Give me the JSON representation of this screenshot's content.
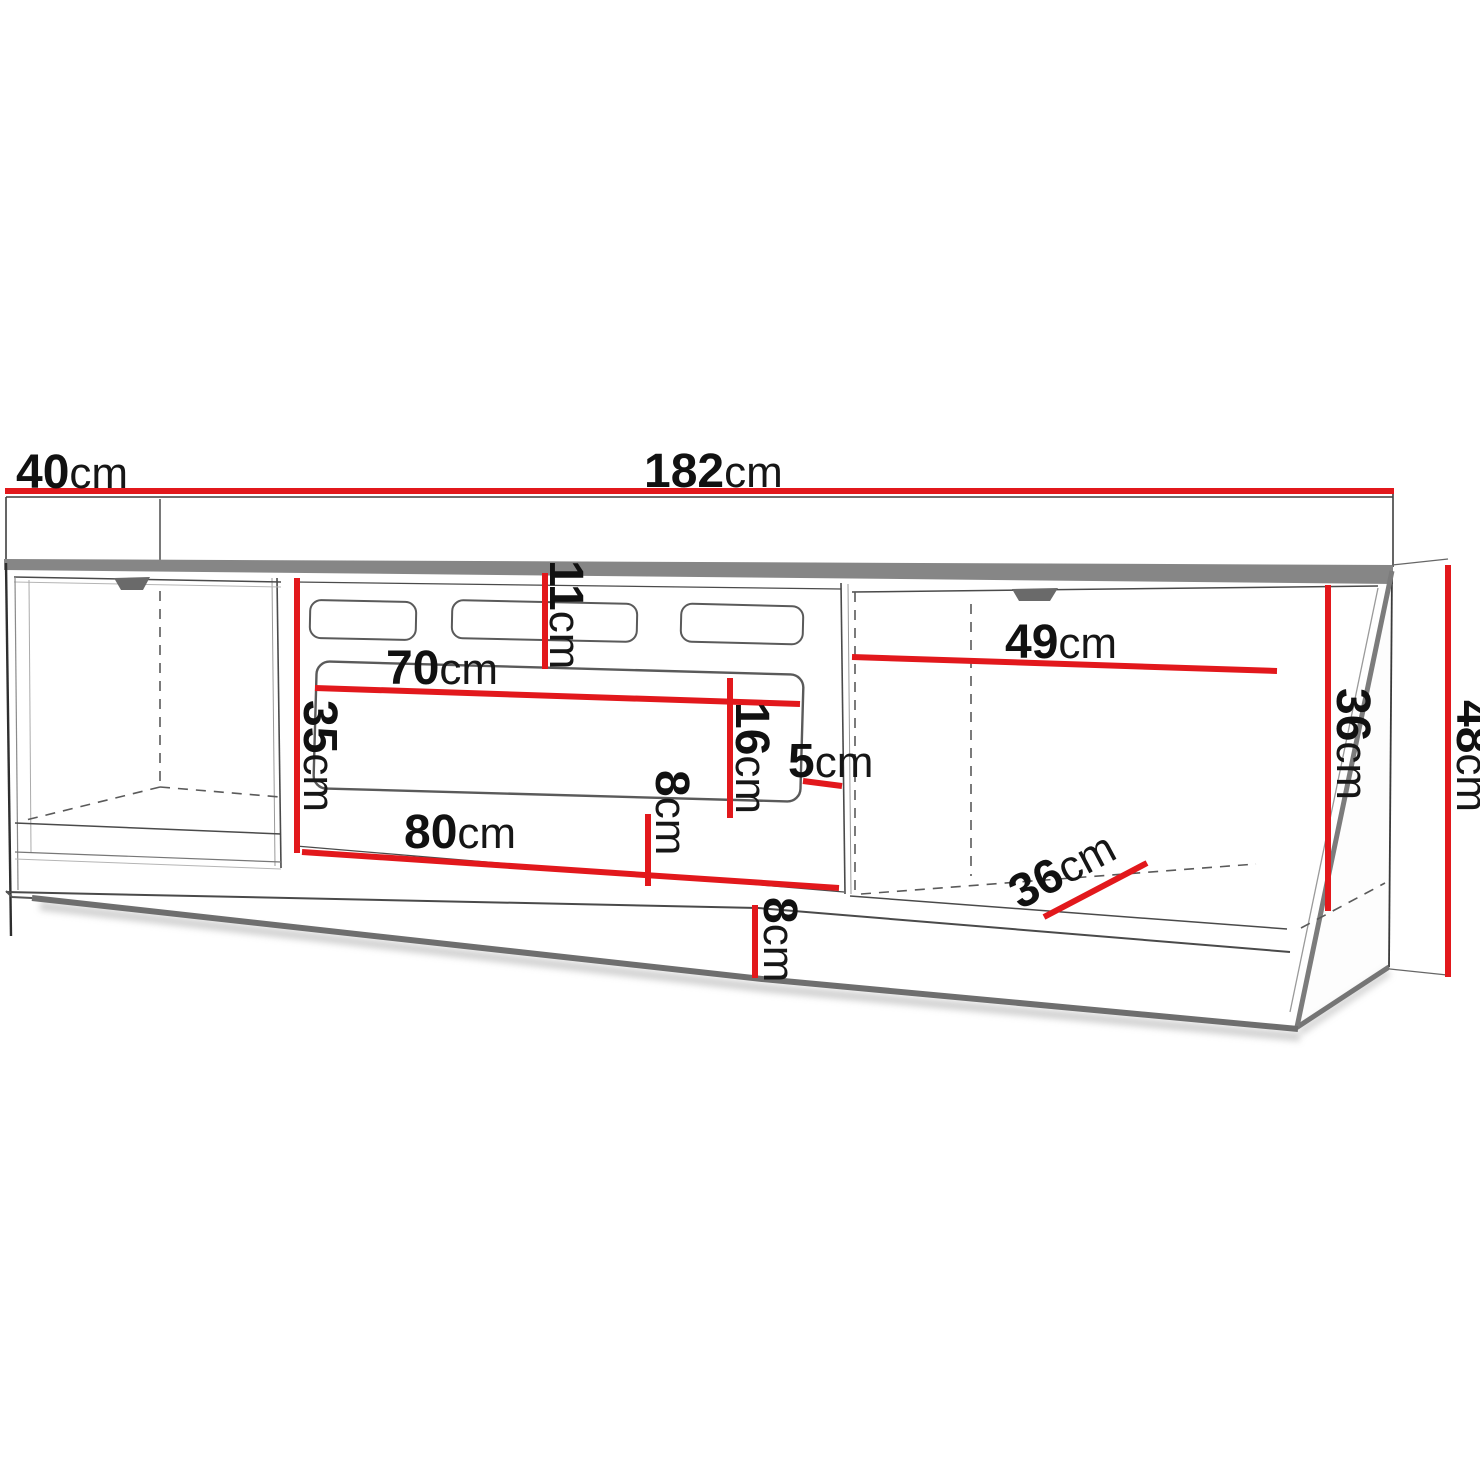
{
  "diagram": {
    "type": "furniture-dimension-drawing",
    "subject": "tv-stand-cabinet",
    "unit": "cm",
    "accent_color": "#e2181c",
    "line_color": "#3f3f3f",
    "labels": [
      {
        "id": "depth-top",
        "value": "40",
        "unit": "cm"
      },
      {
        "id": "width-total",
        "value": "182",
        "unit": "cm"
      },
      {
        "id": "vent-offset-top",
        "value": "11",
        "unit": "cm"
      },
      {
        "id": "opening-top-width",
        "value": "70",
        "unit": "cm"
      },
      {
        "id": "left-inner-height",
        "value": "35",
        "unit": "cm"
      },
      {
        "id": "opening-height",
        "value": "16",
        "unit": "cm"
      },
      {
        "id": "side-gap",
        "value": "5",
        "unit": "cm"
      },
      {
        "id": "opening-floor-gap",
        "value": "8",
        "unit": "cm"
      },
      {
        "id": "opening-bottom-width",
        "value": "80",
        "unit": "cm"
      },
      {
        "id": "right-opening-width",
        "value": "49",
        "unit": "cm"
      },
      {
        "id": "right-inner-height",
        "value": "36",
        "unit": "cm"
      },
      {
        "id": "total-height",
        "value": "48",
        "unit": "cm"
      },
      {
        "id": "inner-depth",
        "value": "36",
        "unit": "cm"
      },
      {
        "id": "plinth-height",
        "value": "8",
        "unit": "cm"
      }
    ]
  }
}
